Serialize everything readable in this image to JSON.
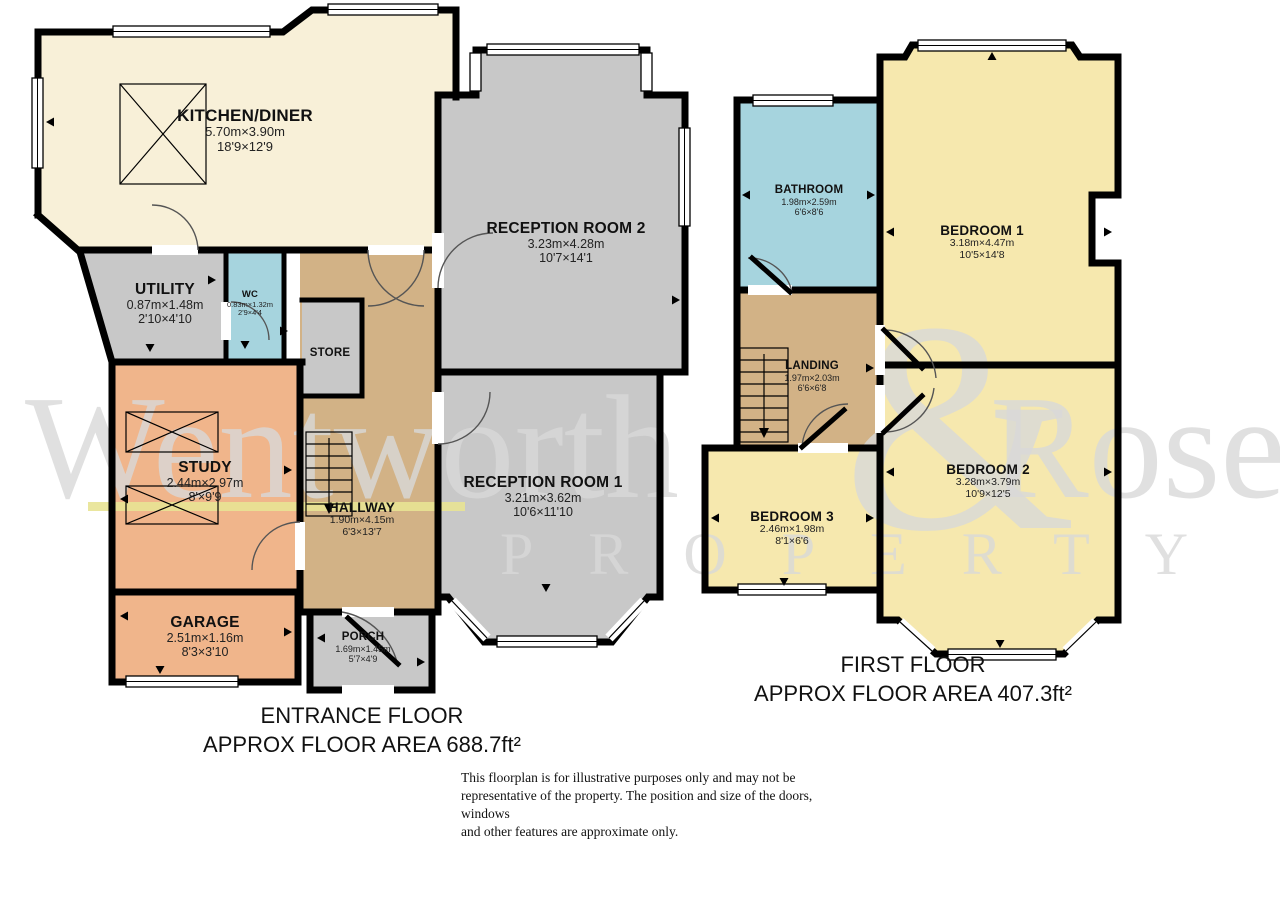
{
  "watermark": {
    "name_left": "Wentworth",
    "ampersand": "&",
    "name_right": "Rose",
    "subtitle": "PROPERTY"
  },
  "entrance_floor": {
    "caption_line1": "ENTRANCE FLOOR",
    "caption_line2": "APPROX FLOOR AREA 688.7ft²",
    "rooms": {
      "kitchen": {
        "name": "KITCHEN/DINER",
        "metric": "5.70m×3.90m",
        "imperial": "18'9×12'9"
      },
      "reception2": {
        "name": "RECEPTION ROOM 2",
        "metric": "3.23m×4.28m",
        "imperial": "10'7×14'1"
      },
      "utility": {
        "name": "UTILITY",
        "metric": "0.87m×1.48m",
        "imperial": "2'10×4'10"
      },
      "wc": {
        "name": "WC",
        "metric": "0.83m×1.32m",
        "imperial": "2'9×4'4"
      },
      "store": {
        "name": "STORE"
      },
      "hallway": {
        "name": "HALLWAY",
        "metric": "1.90m×4.15m",
        "imperial": "6'3×13'7"
      },
      "reception1": {
        "name": "RECEPTION ROOM 1",
        "metric": "3.21m×3.62m",
        "imperial": "10'6×11'10"
      },
      "study": {
        "name": "STUDY",
        "metric": "2.44m×2.97m",
        "imperial": "8'×9'9"
      },
      "garage": {
        "name": "GARAGE",
        "metric": "2.51m×1.16m",
        "imperial": "8'3×3'10"
      },
      "porch": {
        "name": "PORCH",
        "metric": "1.69m×1.45m",
        "imperial": "5'7×4'9"
      }
    }
  },
  "first_floor": {
    "caption_line1": "FIRST FLOOR",
    "caption_line2": "APPROX FLOOR AREA 407.3ft²",
    "rooms": {
      "bathroom": {
        "name": "BATHROOM",
        "metric": "1.98m×2.59m",
        "imperial": "6'6×8'6"
      },
      "bedroom1": {
        "name": "BEDROOM 1",
        "metric": "3.18m×4.47m",
        "imperial": "10'5×14'8"
      },
      "landing": {
        "name": "LANDING",
        "metric": "1.97m×2.03m",
        "imperial": "6'6×6'8"
      },
      "bedroom2": {
        "name": "BEDROOM 2",
        "metric": "3.28m×3.79m",
        "imperial": "10'9×12'5"
      },
      "bedroom3": {
        "name": "BEDROOM 3",
        "metric": "2.46m×1.98m",
        "imperial": "8'1×6'6"
      }
    }
  },
  "disclaimer": {
    "line1": "This floorplan is for illustrative purposes only and may not be",
    "line2": "representative of the property. The position and size of the doors, windows",
    "line3": "and other features are approximate only."
  },
  "colors": {
    "kitchen_cream": "#F8F0D8",
    "room_gray": "#C8C8C8",
    "wet_room_blue": "#A6D4DE",
    "hall_tan": "#D2B286",
    "study_peach": "#F0B58B",
    "bedroom_yellow": "#F6E8AE",
    "wall_black": "#000000",
    "watermark_gray": "#DCDCDC",
    "underline_yellow": "#E8E393"
  }
}
